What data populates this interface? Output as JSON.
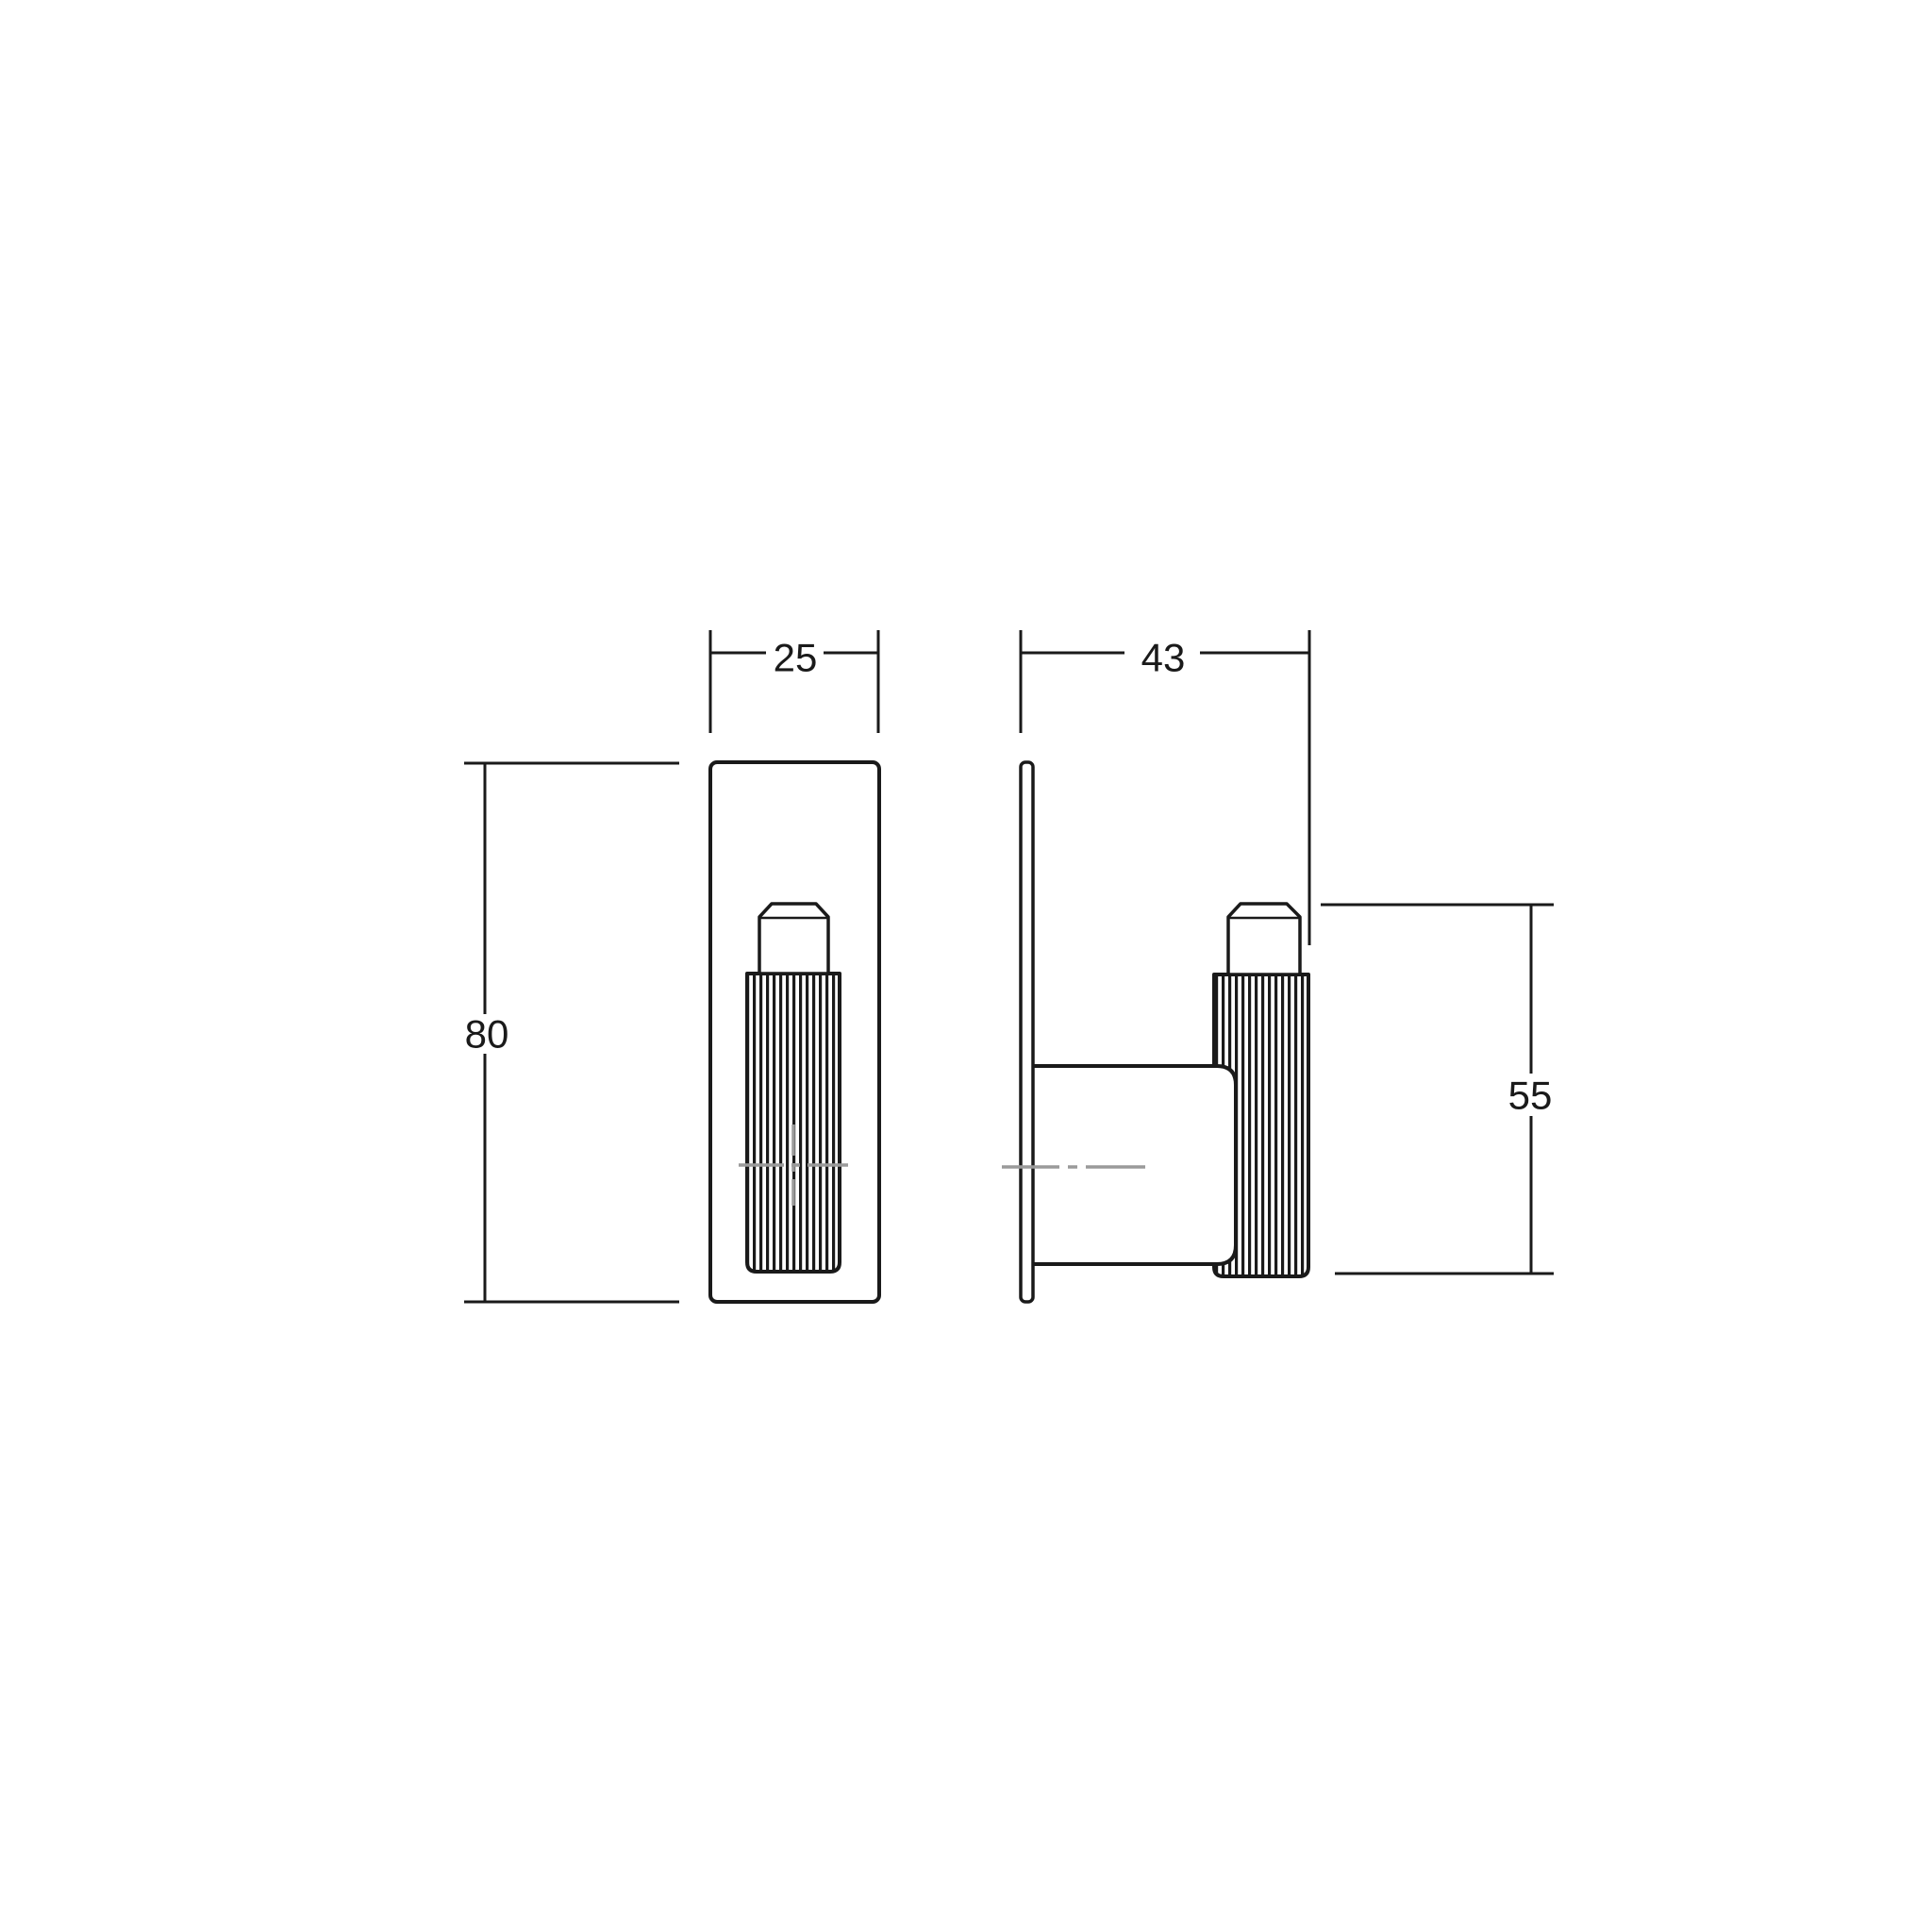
{
  "drawing": {
    "description": "Technical dimension drawing of a wall-mounted knurled hook, front view and side view",
    "dimensions": {
      "front_width": "25",
      "front_height": "80",
      "side_depth": "43",
      "knob_height": "55"
    },
    "colors": {
      "line": "#1a1a1a",
      "centerline": "#9a9a9a",
      "background": "#ffffff"
    }
  }
}
